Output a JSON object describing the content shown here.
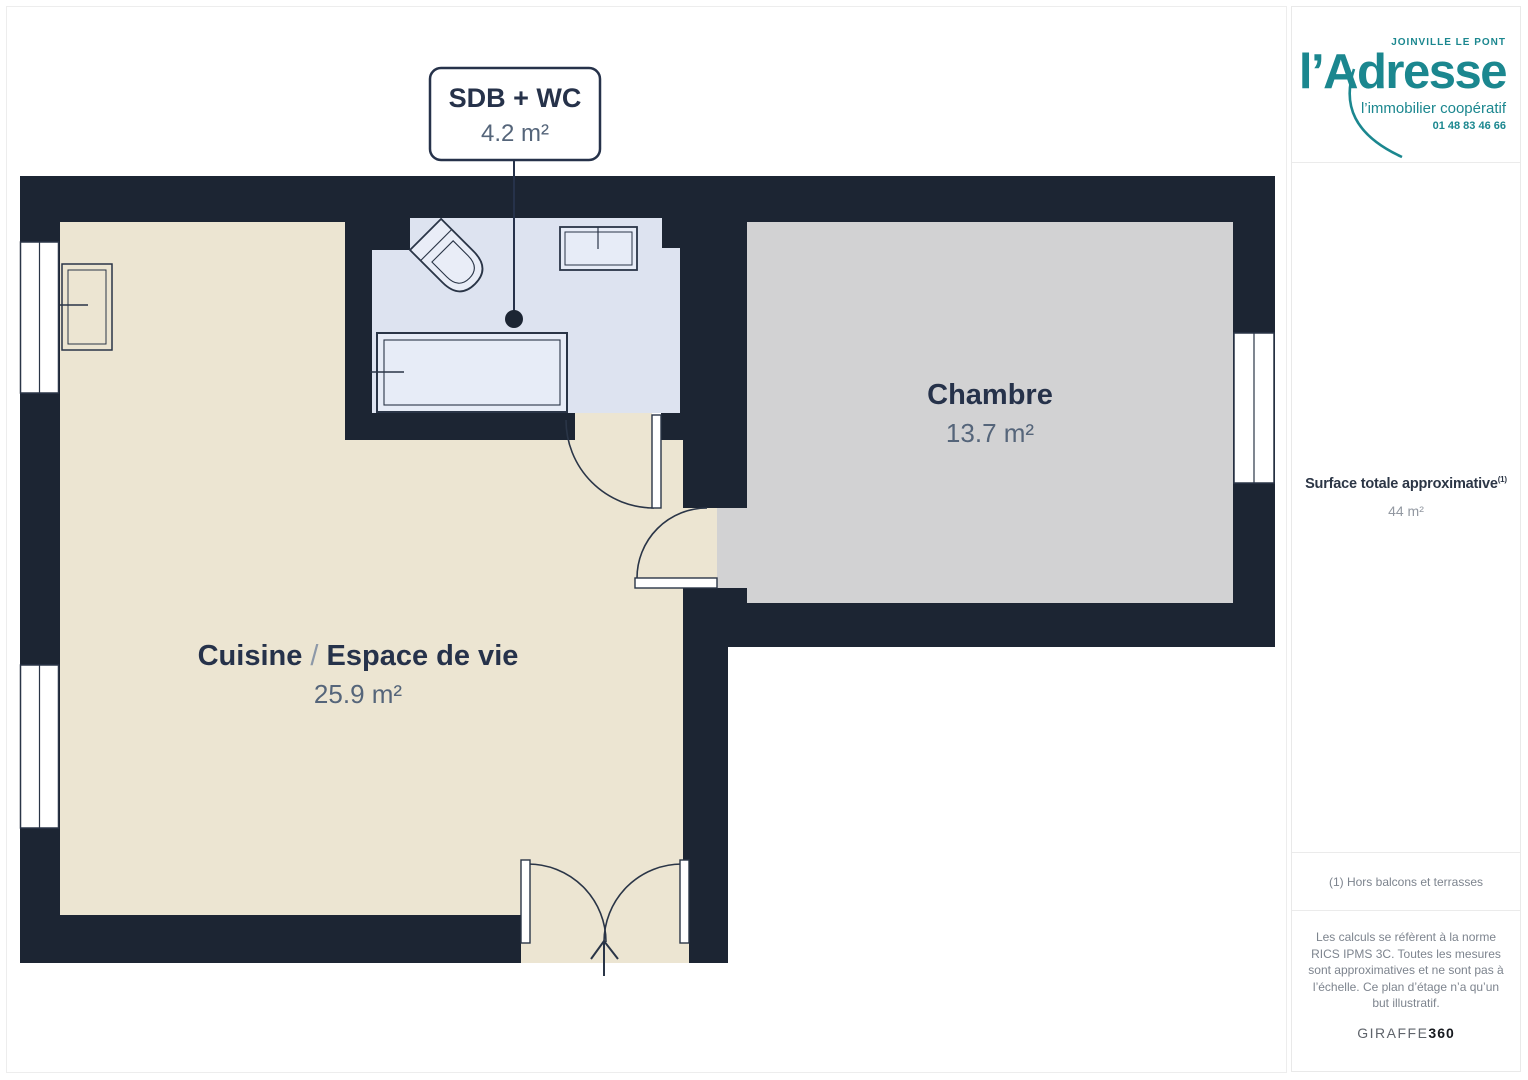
{
  "plan": {
    "bathroom_label": {
      "title": "SDB + WC",
      "area": "4.2 m²"
    },
    "bedroom_label": {
      "title": "Chambre",
      "area": "13.7 m²"
    },
    "kitchen_label": {
      "title_left": "Cuisine",
      "separator": " / ",
      "title_right": "Espace de vie",
      "area": "25.9 m²"
    }
  },
  "sidebar": {
    "logo": {
      "location": "JOINVILLE LE PONT",
      "brand": "l’Adresse",
      "tagline": "l’immobilier coopératif",
      "phone": "01 48 83 46 66"
    },
    "surface": {
      "label": "Surface totale approximative",
      "superscript": "(1)",
      "value": "44 m²"
    },
    "note": "(1) Hors balcons et terrasses",
    "legal": "Les calculs se réfèrent à la norme RICS IPMS 3C. Toutes les mesures sont approximatives et ne sont pas à l’échelle. Ce plan d’étage n’a qu’un but illustratif.",
    "watermark": {
      "brand": "GIRAFFE",
      "suffix": "360"
    }
  },
  "colors": {
    "wall": "#1c2533",
    "kitchen_floor": "#ece5d2",
    "bedroom_floor": "#d2d2d3",
    "bathroom_floor": "#dde3f0",
    "brand_teal": "#1b878f",
    "text_navy": "#26324a",
    "text_muted": "#55657a"
  }
}
